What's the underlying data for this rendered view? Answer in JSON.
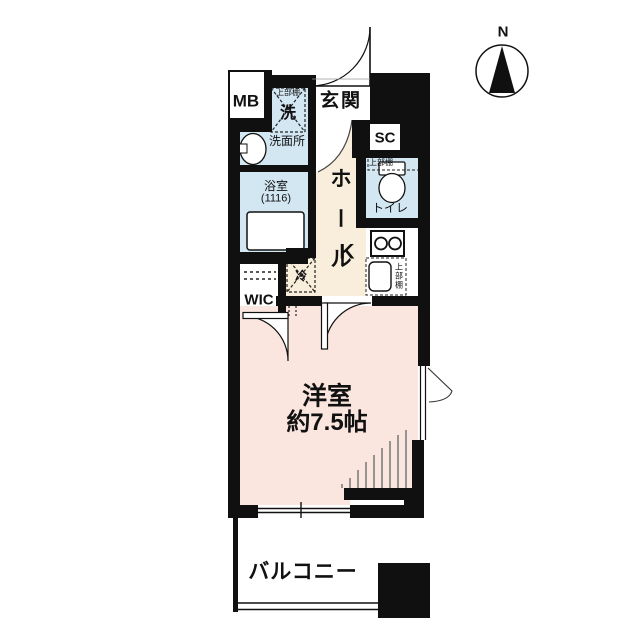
{
  "compass": {
    "label": "N"
  },
  "colors": {
    "wall": "#101010",
    "wet_area": "#d3e7f3",
    "hall_area": "#f8eedb",
    "room_area": "#fbe5df",
    "white_area": "#ffffff"
  },
  "rooms": {
    "entrance": {
      "label": "玄関"
    },
    "hall": {
      "label": "ホール",
      "chars": [
        "ホ",
        "ー",
        "ル"
      ]
    },
    "washroom": {
      "label": "洗面所"
    },
    "bathroom": {
      "label": "浴室",
      "size_note": "(1116)"
    },
    "toilet": {
      "label": "トイレ",
      "shelf_note": "上部棚"
    },
    "kitchen": {
      "label": "K",
      "shelf_note": "上部棚"
    },
    "wic": {
      "label": "WIC"
    },
    "western_room": {
      "label": "洋室",
      "size": "約7.5帖"
    },
    "balcony": {
      "label": "バルコニー"
    }
  },
  "fixtures": {
    "meter_box": {
      "label": "MB"
    },
    "shoe_closet": {
      "label": "SC"
    },
    "washer_space": {
      "label": "洗",
      "shelf_note": "上部棚"
    },
    "refrigerator": {
      "label": "冷"
    }
  }
}
